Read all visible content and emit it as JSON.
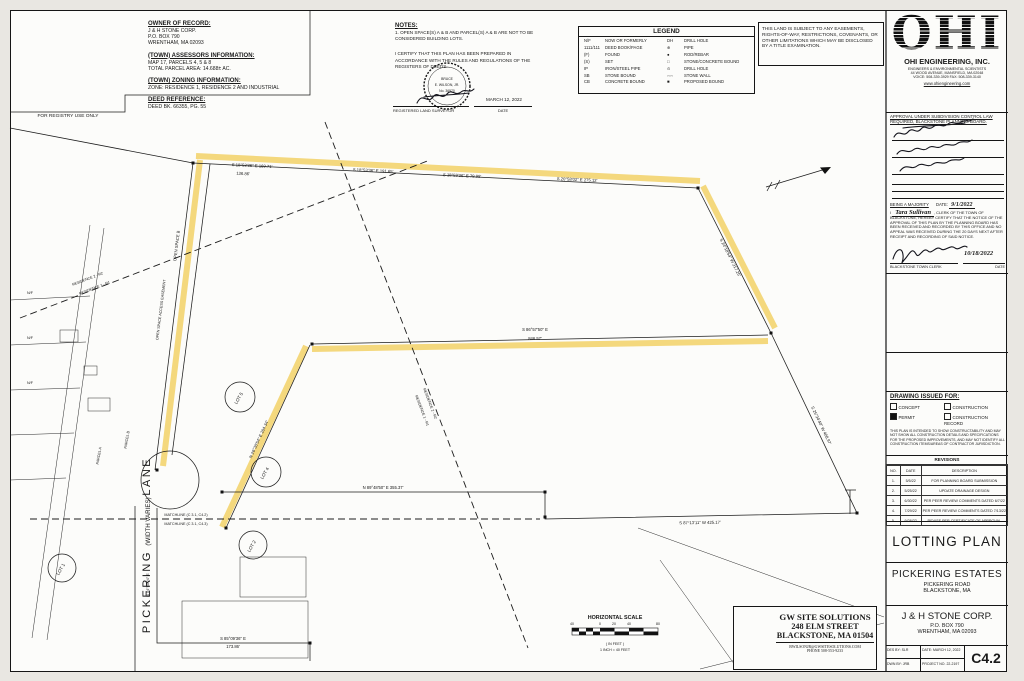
{
  "registry": {
    "label": "FOR REGISTRY USE ONLY"
  },
  "owner": {
    "heading": "OWNER OF RECORD:",
    "line1": "J & H STONE CORP.",
    "line2": "P.O. BOX 790",
    "line3": "WRENTHAM, MA 02093"
  },
  "assessors": {
    "heading": "(TOWN) ASSESSORS INFORMATION:",
    "line1": "MAP 17, PARCELS 4, 5 & 8",
    "line2": "TOTAL PARCEL AREA: 14.688± AC."
  },
  "zoning": {
    "heading": "(TOWN) ZONING INFORMATION:",
    "line1": "ZONE: RESIDENCE 1, RESIDENCE 2 AND INDUSTRIAL"
  },
  "deed": {
    "heading": "DEED REFERENCE:",
    "line1": "DEED BK. 66355, PG. 55"
  },
  "notes": {
    "heading": "NOTES:",
    "note1a": "1. OPEN SPACE(S) A & B AND PARCEL(S) A & B ARE NOT TO BE",
    "note1b": "    CONSIDERED BUILDING LOTS.",
    "cert1": "I CERTIFY THAT THIS PLAN HAS BEEN PREPARED IN",
    "cert2": "ACCORDANCE WITH THE RULES AND REGULATIONS OF THE",
    "cert3": "REGISTERS OF DEEDS."
  },
  "surveyor": {
    "seal1": "BRUCE",
    "seal2": "E. WILSON, JR.",
    "seal3": "No. 36970",
    "reg_label": "REGISTERED LAND SURVEYOR",
    "date_value": "MARCH 12, 2022",
    "date_label": "DATE"
  },
  "legend": {
    "title": "LEGEND",
    "left": [
      [
        "N/F",
        "NOW OR FORMERLY"
      ],
      [
        "1111/111",
        "DEED BOOK/PAGE"
      ],
      [
        "(F)",
        "FOUND"
      ],
      [
        "(S)",
        "SET"
      ],
      [
        "IP",
        "IRON/STEEL PIPE"
      ],
      [
        "SB",
        "STONE BOUND"
      ],
      [
        "CB",
        "CONCRETE BOUND"
      ]
    ],
    "right": [
      [
        "DH",
        "DRILL HOLE"
      ],
      [
        "⊕",
        "PIPE"
      ],
      [
        "●",
        "ROD/REBAR"
      ],
      [
        "□",
        "STONE/CONCRETE BOUND"
      ],
      [
        "⊙",
        "DRILL HOLE"
      ],
      [
        "◦◦◦◦",
        "STONE WALL"
      ],
      [
        "■",
        "PROPOSED BOUND"
      ]
    ]
  },
  "disclaimer": {
    "text": "THIS LAND IS SUBJECT TO ANY EASEMENTS, RIGHTS-OF-WAY, RESTRICTIONS, COVENANTS, OR OTHER LIMITATIONS WHICH MAY BE DISCLOSED BY A TITLE EXAMINATION."
  },
  "firm": {
    "logo": "OHI",
    "name": "OHI ENGINEERING, INC.",
    "tagline": "ENGINEERS & ENVIRONMENTAL SCIENTISTS",
    "address": "44 WOOD AVENUE, MANSFIELD, MA 02048",
    "phones": "VOICE: 508-339-3929   FAX: 508-339-3140",
    "web": "www.ohiengineering.com"
  },
  "approval": {
    "heading1": "APPROVAL UNDER SUBDIVISION CONTROL LAW",
    "heading2": "REQUIRED, BLACKSTONE PLANNING BOARD.",
    "majority": "BEING A MAJORITY",
    "date_label": "DATE:",
    "date_value": "9/1/2022",
    "clerk_pre": "I",
    "clerk_name": "Tara Sullivan",
    "clerk_text": ", CLERK OF THE TOWN OF BLACKSTONE, HEREBY CERTIFY THAT THE NOTICE OF THE APPROVAL OF THIS PLAN BY THE PLANNING BOARD HAS BEEN RECEIVED AND RECORDED BY THIS OFFICE AND NO APPEAL WAS RECEIVED DURING THE 20 DAYS NEXT AFTER RECEIPT AND RECORDING OF SAID NOTICE.",
    "clerk_sig_label": "BLACKSTONE TOWN CLERK",
    "clerk_date": "10/18/2022",
    "clerk_date_label": "DATE"
  },
  "issued": {
    "heading": "DRAWING ISSUED FOR:",
    "opt1": "CONCEPT",
    "opt2": "CONSTRUCTION",
    "opt3": "PERMIT",
    "opt4": "CONSTRUCTION RECORD",
    "fine_print": "THIS PLAN IS INTENDED TO SHOW CONSTRUCTABILITY AND MAY NOT SHOW ALL CONSTRUCTION DETAILS AND SPECIFICATIONS FOR THE PROPOSED IMPROVEMENTS, AND MAY NOT IDENTIFY ALL CONSTRUCTION ITEMS/AREAS OF CONTRACTOR JURISDICTION."
  },
  "revisions": {
    "title": "REVISIONS",
    "headers": [
      "NO.",
      "DATE",
      "DESCRIPTION"
    ],
    "rows": [
      [
        "1.",
        "5/5/22",
        "FOR PLANNING BOARD SUBMISSION"
      ],
      [
        "2.",
        "5/25/22",
        "UPDATE DRAINAGE DESIGN"
      ],
      [
        "3.",
        "6/30/22",
        "PER PEER REVIEW COMMENTS DATED 6/7/22"
      ],
      [
        "4.",
        "7/29/22",
        "PER PEER REVIEW COMMENTS DATED 7/13/22"
      ],
      [
        "5.",
        "9/28/22",
        "REVISE PER CERTIFICATE OF APPROVAL"
      ]
    ]
  },
  "titles": {
    "plan": "LOTTING PLAN",
    "project": "PICKERING ESTATES",
    "road": "PICKERING ROAD",
    "town": "BLACKSTONE, MA",
    "client": "J & H STONE CORP.",
    "client_addr1": "P.O. BOX 790",
    "client_addr2": "WRENTHAM, MA 02093",
    "des_by": "DES BY: SLR",
    "dwn_by": "DWN BY: JRB",
    "date": "DATE: MARCH 12, 2022",
    "project_no": "PROJECT NO. 22-2197",
    "sheet": "C4.2"
  },
  "gw": {
    "name": "GW SITE SOLUTIONS",
    "addr1": "248 ELM STREET",
    "addr2": "BLACKSTONE, MA 01504",
    "email": "BWILSONJR@GWSITESOLUTIONS.COM",
    "phone": "PHONE   508-553-9233"
  },
  "scale": {
    "title": "HORIZONTAL SCALE",
    "tick1": "40",
    "tick2": "0",
    "tick3": "20",
    "tick4": "40",
    "tick5": "80",
    "unit": "( IN FEET )",
    "ratio": "1 INCH = 40 FEET"
  },
  "drawing": {
    "highlight_color": "#f1cf62",
    "bearing_top_1": "S 18°53'36\" E   169.71'",
    "bearing_top_1b": "136.86'",
    "bearing_top_2": "S 18°53'36\" E   191.65'",
    "bearing_top_3": "S 18°59'36\" E   79.98'",
    "bearing_top_4": "S 20°58'02\" E   275.12'",
    "bearing_ne": "S 24°18'54\" W   317.25'",
    "bearing_mid": "S 86°57'50\" E",
    "bearing_mid_len": "846.57'",
    "bearing_east": "S 25°34'40\" W   408.97'",
    "bearing_sw": "N 26°30'54\" E   204.34'",
    "bearing_bottom": "N 89°48'50\" E   355.37'",
    "bearing_lower_right": "S 87°13'11\" W   425.17'",
    "bearing_lane_bottom": "S 85°09'36\" E",
    "bearing_lane_bottom_len": "173.86'",
    "bearing_lane": "N 04°50'24\" E",
    "matchline_top": "MATCHLINE (C 3.1, C4.2)",
    "matchline_bottom": "MATCHLINE (C 3.1, C4.3)",
    "zone_r2": "RESIDENCE 2 - R2",
    "zone_r1": "RESIDENCE 1 - R1",
    "open_space_b": "OPEN SPACE B",
    "open_space_easement": "OPEN SPACE ACCESS EASEMENT",
    "parcel_a": "PARCEL A",
    "parcel_b": "PARCEL B",
    "street_name_1": "PICKERING",
    "street_name_2": " (WIDTH VARIES) ",
    "street_name_3": "LANE",
    "lot1": "LOT 1",
    "lot2": "LOT 2",
    "lot4": "LOT 4",
    "lot5": "LOT 5",
    "abutter": "N/F"
  }
}
